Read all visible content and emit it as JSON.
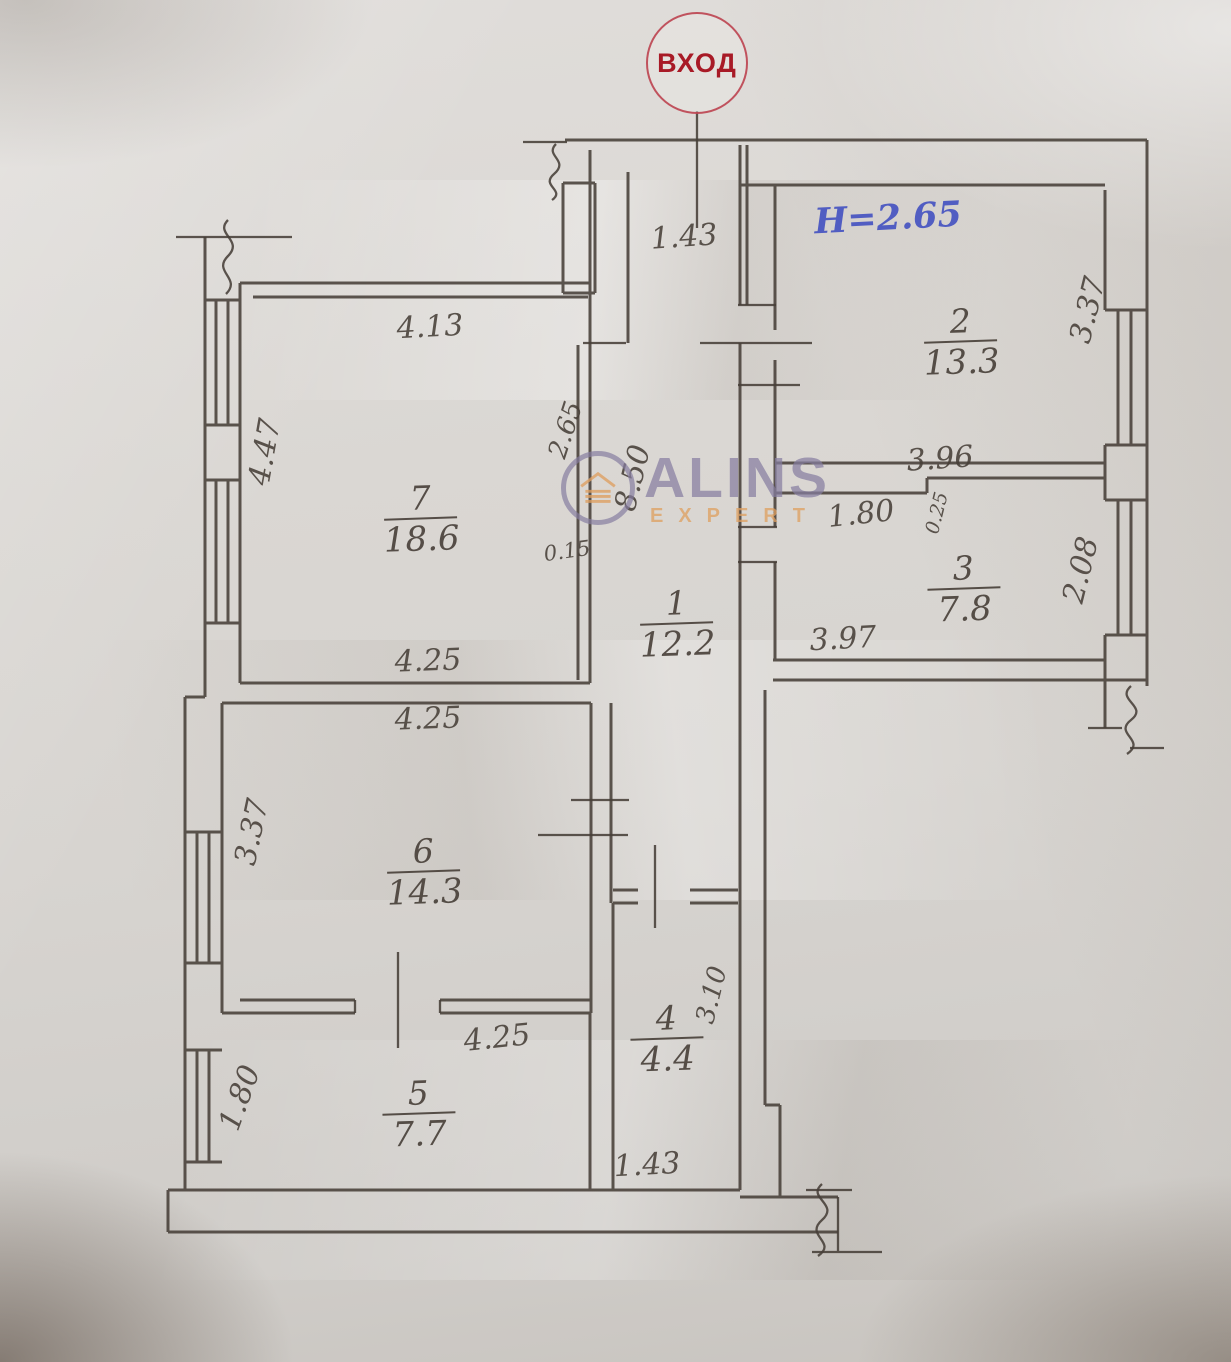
{
  "plan": {
    "entrance": {
      "label": "ВХОД"
    },
    "height_note": "H=2.65",
    "rooms": [
      {
        "num": "1",
        "area": "12.2",
        "x": 677,
        "y": 625
      },
      {
        "num": "2",
        "area": "13.3",
        "x": 961,
        "y": 343
      },
      {
        "num": "3",
        "area": "7.8",
        "x": 964,
        "y": 590
      },
      {
        "num": "4",
        "area": "4.4",
        "x": 667,
        "y": 1040
      },
      {
        "num": "5",
        "area": "7.7",
        "x": 419,
        "y": 1115
      },
      {
        "num": "6",
        "area": "14.3",
        "x": 424,
        "y": 873
      },
      {
        "num": "7",
        "area": "18.6",
        "x": 421,
        "y": 520
      }
    ],
    "dimensions": [
      {
        "t": "1.43",
        "x": 684,
        "y": 237,
        "r": -4,
        "s": 30
      },
      {
        "t": "4.13",
        "x": 430,
        "y": 327,
        "r": -3,
        "s": 30
      },
      {
        "t": "4.47",
        "x": 265,
        "y": 452,
        "r": -80,
        "s": 30
      },
      {
        "t": "2.65",
        "x": 566,
        "y": 430,
        "r": -72,
        "s": 26
      },
      {
        "t": "8.50",
        "x": 633,
        "y": 478,
        "r": -76,
        "s": 30
      },
      {
        "t": "0.15",
        "x": 567,
        "y": 551,
        "r": -8,
        "s": 21
      },
      {
        "t": "4.25",
        "x": 428,
        "y": 661,
        "r": -2,
        "s": 30
      },
      {
        "t": "4.25",
        "x": 428,
        "y": 719,
        "r": -2,
        "s": 30
      },
      {
        "t": "3.37",
        "x": 252,
        "y": 832,
        "r": -78,
        "s": 30
      },
      {
        "t": "4.25",
        "x": 497,
        "y": 1038,
        "r": -6,
        "s": 30
      },
      {
        "t": "1.80",
        "x": 240,
        "y": 1098,
        "r": -70,
        "s": 30
      },
      {
        "t": "1.43",
        "x": 647,
        "y": 1165,
        "r": -3,
        "s": 30
      },
      {
        "t": "3.10",
        "x": 712,
        "y": 995,
        "r": -76,
        "s": 26
      },
      {
        "t": "3.37",
        "x": 1088,
        "y": 310,
        "r": -76,
        "s": 30
      },
      {
        "t": "3.96",
        "x": 940,
        "y": 459,
        "r": -4,
        "s": 30
      },
      {
        "t": "1.80",
        "x": 861,
        "y": 514,
        "r": -6,
        "s": 30
      },
      {
        "t": "0.25",
        "x": 937,
        "y": 513,
        "r": -76,
        "s": 19
      },
      {
        "t": "2.08",
        "x": 1081,
        "y": 570,
        "r": -76,
        "s": 30
      },
      {
        "t": "3.97",
        "x": 843,
        "y": 639,
        "r": -3,
        "s": 30
      }
    ]
  },
  "watermark": {
    "title": "ALINS",
    "subtitle": "EXPERT"
  },
  "colors": {
    "pencil": "#473f38",
    "red": "#a81a26",
    "blue": "#3a49c0",
    "wm-purple": "#867da0",
    "wm-orange": "#de9f60"
  }
}
